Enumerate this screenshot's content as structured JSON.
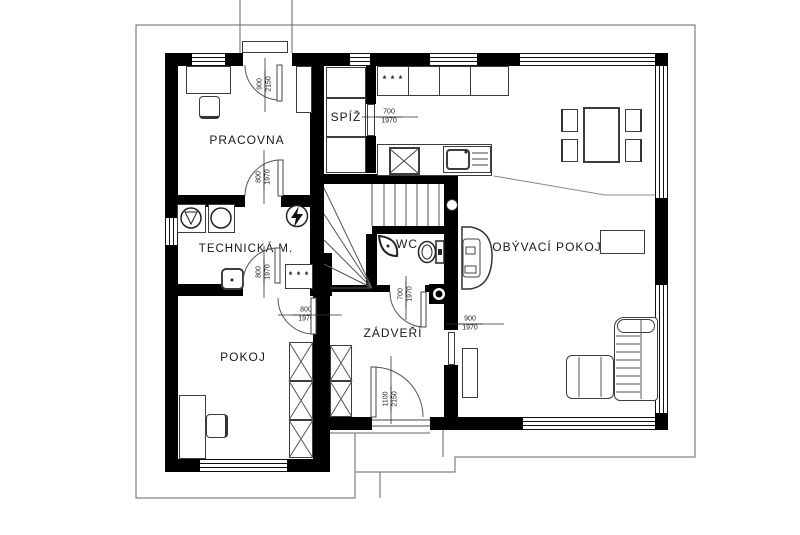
{
  "rooms": {
    "pracovna": "PRACOVNA",
    "technicka": "TECHNICKÁ M.",
    "spiz": "SPÍŽ",
    "wc": "WC",
    "zadveri": "ZÁDVEŘÍ",
    "obyvaci": "OBÝVACÍ POKOJ",
    "pokoj": "POKOJ"
  },
  "dims": [
    {
      "w": "900",
      "h": "2150"
    },
    {
      "w": "800",
      "h": "1970"
    },
    {
      "w": "700",
      "h": "1970"
    },
    {
      "w": "800",
      "h": "1970"
    },
    {
      "w": "800",
      "h": "1970"
    },
    {
      "w": "700",
      "h": "1970"
    },
    {
      "w": "1100",
      "h": "2150"
    },
    {
      "w": "900",
      "h": "1970"
    }
  ],
  "symbols": {
    "radiator": "* * *"
  },
  "colors": {
    "wall": "#000000",
    "line": "#444444",
    "background": "#ffffff"
  }
}
